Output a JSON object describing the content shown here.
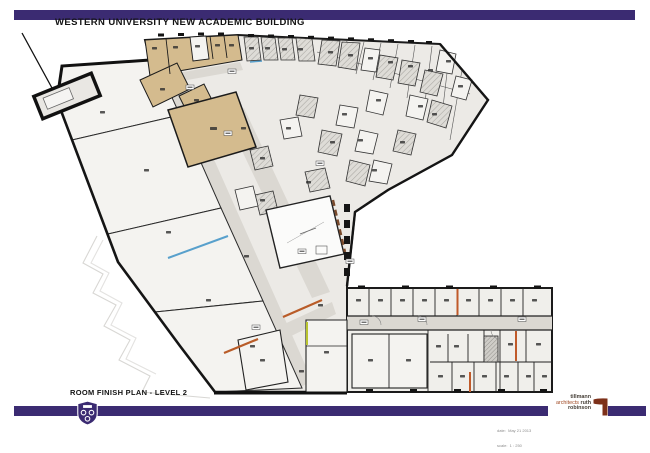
{
  "header": {
    "title": "WESTERN UNIVERSITY NEW ACADEMIC BUILDING"
  },
  "footer": {
    "plan_title": "ROOM FINISH PLAN - LEVEL 2",
    "note_date": "date:  May 21 2013",
    "note_scale": "scale:  1 : 250",
    "firm": {
      "line1": "tillmann",
      "line2_accent": "architects",
      "line2_bold": "ruth",
      "line3": "robinson"
    }
  },
  "colors": {
    "brand_purple": "#3b2b72",
    "wall": "#1b1b1b",
    "building_fill": "#eceae6",
    "room_light": "#f4f3f0",
    "corridor": "#dbd8d2",
    "tan_room": "#d4bb8e",
    "accent_orange": "#c05a2a",
    "accent_blue": "#58a0cc",
    "accent_green": "#b9c430",
    "accent_brown": "#7a4a2b",
    "logo_rust": "#7d3019",
    "logo_accent_text": "#a14a24"
  },
  "icons": [
    "university-shield-icon",
    "architect-logo-mark-icon"
  ]
}
